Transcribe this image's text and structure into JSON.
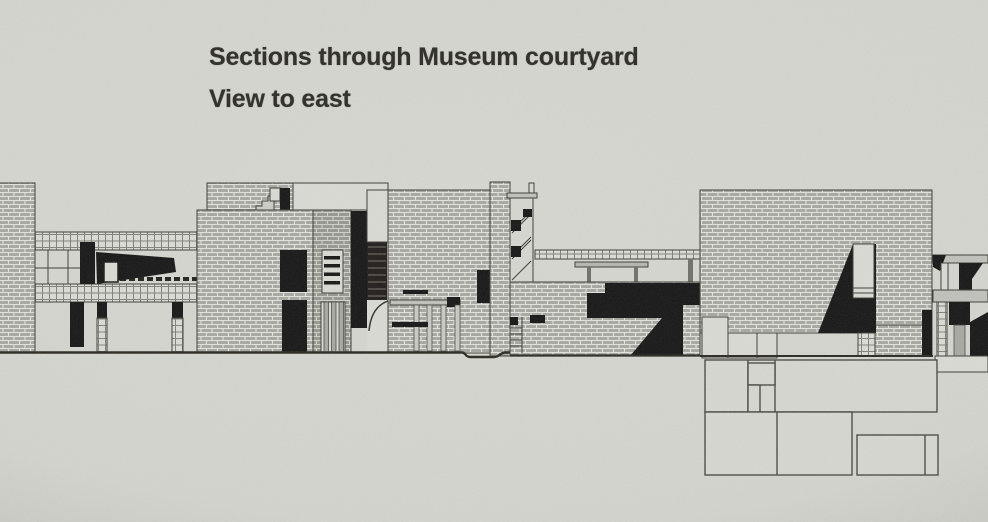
{
  "title": {
    "line1": "Sections through Museum courtyard",
    "line2": "View to east"
  },
  "colors": {
    "paper": "#d3d4cd",
    "ink": "#3c3c35",
    "brick_fill": "#a7a8a1",
    "brick_dark_fill": "#96978f",
    "glassblock_fill": "#dadbd4",
    "shadow_black": "#191914",
    "title_text": "#2b2a25"
  },
  "drawing": {
    "type": "architectural-section",
    "parts": [
      "left-boundary-wall",
      "left-pavilion",
      "upper-gallery-band",
      "central-gallery-block",
      "entry-portico-block",
      "stair-tower",
      "courtyard-bridge",
      "stepped-terrace",
      "east-gallery-block",
      "service-structure",
      "basement-rooms",
      "ground-line"
    ]
  }
}
